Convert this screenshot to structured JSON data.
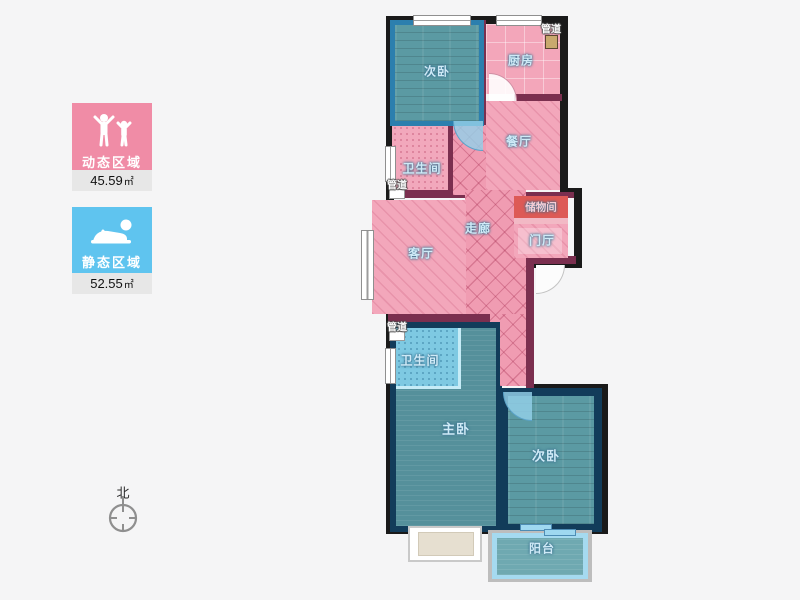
{
  "legend": {
    "dynamic": {
      "label": "动态区域",
      "area_value": "45.59",
      "area_unit": "㎡",
      "color": "#f08ca6"
    },
    "static": {
      "label": "静态区域",
      "area_value": "52.55",
      "area_unit": "㎡",
      "color": "#5fc4ef"
    }
  },
  "compass": {
    "north_label": "北"
  },
  "plan": {
    "rooms": {
      "bedroom_top": {
        "label": "次卧"
      },
      "kitchen": {
        "label": "厨房"
      },
      "dining": {
        "label": "餐厅"
      },
      "bath_top": {
        "label": "卫生间"
      },
      "corridor": {
        "label": "走廊"
      },
      "living": {
        "label": "客厅"
      },
      "storage": {
        "label": "储物间"
      },
      "foyer": {
        "label": "门厅"
      },
      "bath_bottom": {
        "label": "卫生间"
      },
      "master": {
        "label": "主卧"
      },
      "bedroom_bottom": {
        "label": "次卧"
      },
      "balcony": {
        "label": "阳台"
      }
    },
    "pipes": {
      "top": "管道",
      "mid": "管道",
      "bottom": "管道"
    },
    "colors": {
      "dynamic_floor": "#f3a7bb",
      "static_floor": "#55909b",
      "wall_outer": "#1a1a1a",
      "wall_dynamic": "#7b2f4f",
      "wall_static": "#123c5a",
      "highlight_wall": "#2c7fae",
      "storage_fill": "#dd5a56",
      "bath_bottom_fill": "#7ec9e2"
    }
  }
}
